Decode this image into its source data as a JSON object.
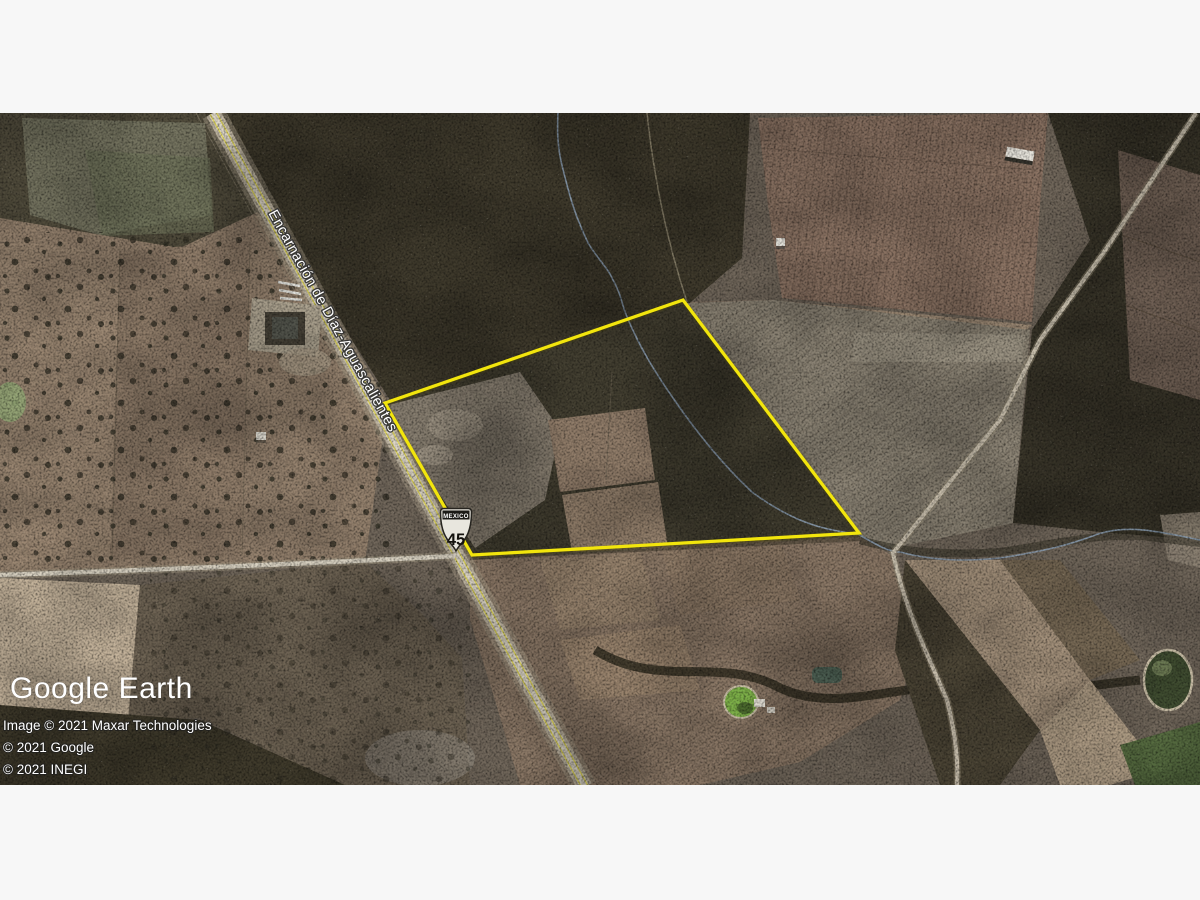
{
  "window": {
    "letterbox_color": "#f7f7f7"
  },
  "map": {
    "road_label": "Encarnación de Díaz-Aguascalientes",
    "highway_shield": {
      "banner": "MEXICO",
      "number": "45"
    },
    "property_polygon": {
      "points": "385,403 683,300 859,533 472,555",
      "stroke": "#F2E50D"
    },
    "logo": "Google Earth",
    "attribution": [
      "Image © 2021 Maxar Technologies",
      "© 2021 Google",
      "© 2021 INEGI"
    ]
  }
}
